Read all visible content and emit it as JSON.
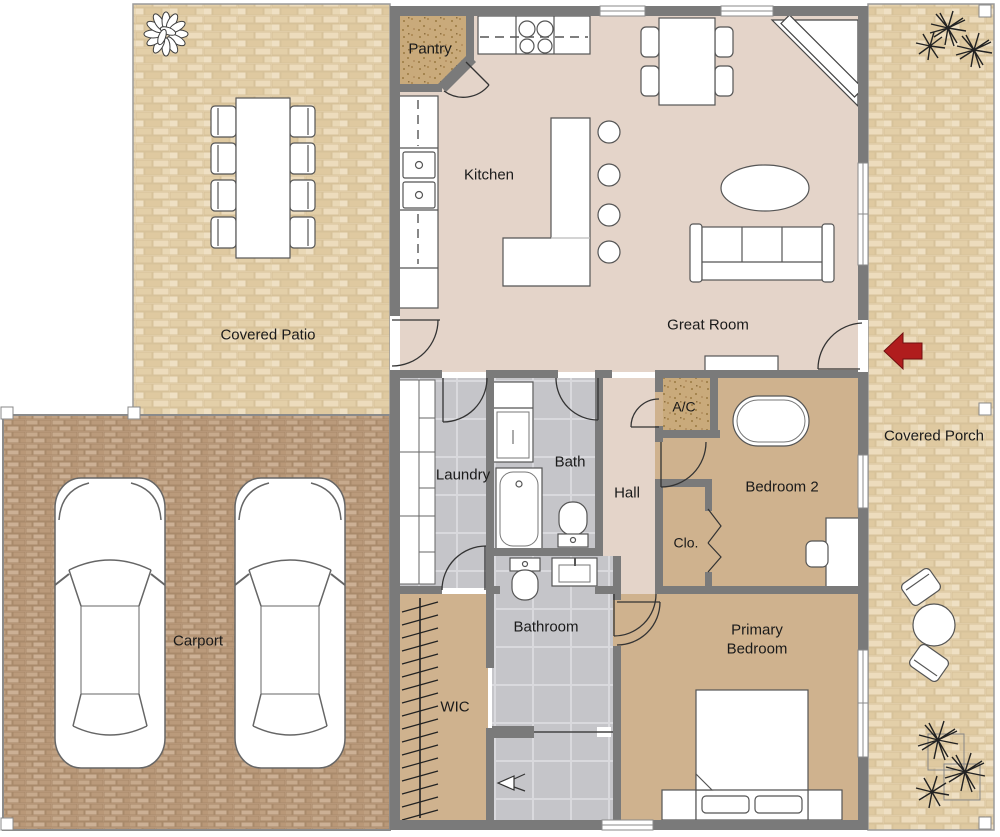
{
  "title": "Single-story house floor plan",
  "rooms": [
    {
      "id": "pantry",
      "label": "Pantry"
    },
    {
      "id": "kitchen",
      "label": "Kitchen"
    },
    {
      "id": "great-room",
      "label": "Great Room"
    },
    {
      "id": "covered-patio",
      "label": "Covered Patio"
    },
    {
      "id": "covered-porch",
      "label": "Covered Porch"
    },
    {
      "id": "laundry",
      "label": "Laundry"
    },
    {
      "id": "bath",
      "label": "Bath"
    },
    {
      "id": "hall",
      "label": "Hall"
    },
    {
      "id": "ac-closet",
      "label": "A/C"
    },
    {
      "id": "bedroom-2",
      "label": "Bedroom 2"
    },
    {
      "id": "closet",
      "label": "Clo."
    },
    {
      "id": "carport",
      "label": "Carport"
    },
    {
      "id": "bathroom",
      "label": "Bathroom"
    },
    {
      "id": "wic",
      "label": "WIC"
    },
    {
      "id": "primary-bedroom",
      "label": "Primary Bedroom"
    }
  ],
  "colors": {
    "wall": "#7a7a7a",
    "living_floor": "#e4d4c9",
    "bedroom_floor": "#cfb28e",
    "tile_floor": "#c5c5c9",
    "patio_brick": "#e8d7b4",
    "carport_brick": "#c2a385",
    "closet_speckle": "#c9aa7b",
    "furniture_fill": "#ffffff",
    "entry_arrow": "#b01d1d"
  },
  "icons": {
    "entry_arrow": "left-arrow"
  }
}
